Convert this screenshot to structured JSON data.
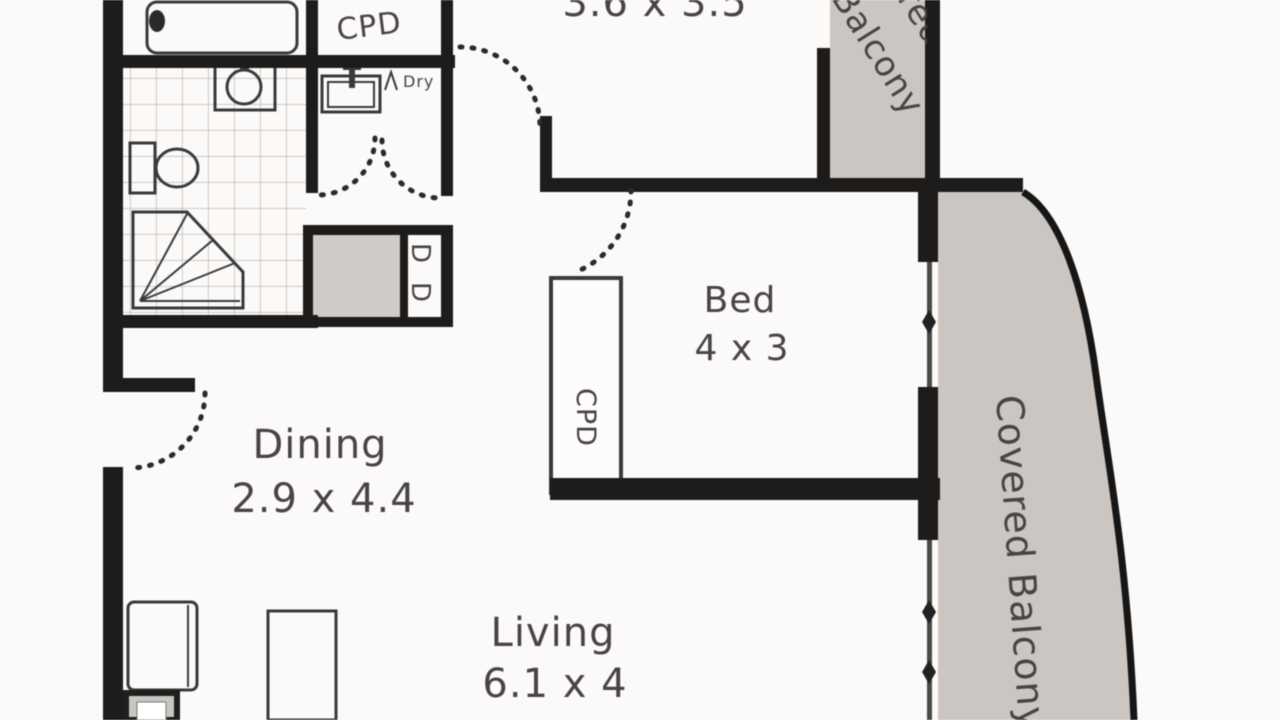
{
  "floorplan": {
    "labels": {
      "top_room_dims": "3.6 x 3.5",
      "bed_name": "Bed",
      "bed_dims": "4 x 3",
      "dining_name": "Dining",
      "dining_dims": "2.9 x 4.4",
      "living_name": "Living",
      "living_dims": "6.1 x 4",
      "balcony_vertical": "Covered Balcony",
      "balcony_top_line1": "Covered",
      "balcony_top_line2": "Balcony",
      "cupboard_top": "CPD",
      "cupboard_bedroom": "CPD",
      "dry": "Dry",
      "robe_letter_top": "D",
      "robe_letter_bottom": "D"
    },
    "colors": {
      "wall": "#1e1c1a",
      "balcony_shade": "#cbc6c2",
      "cupboard_shade": "#d0cbc7",
      "fixture_line": "#3a3a3a",
      "label_text": "#474443",
      "tile_line": "#bcb8b4",
      "background": "#fbfaf9"
    }
  }
}
